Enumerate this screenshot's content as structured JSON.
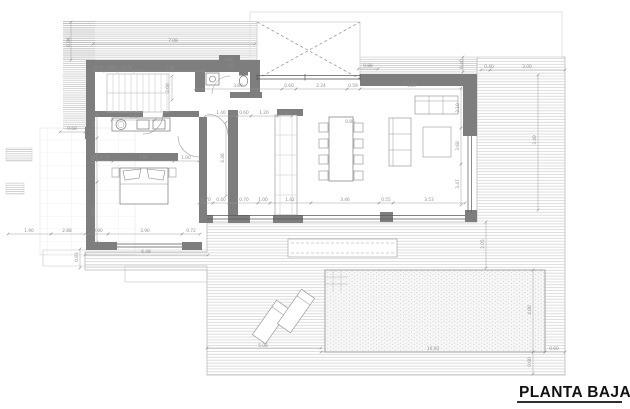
{
  "title": "PLANTA BAJA",
  "colors": {
    "wall": "#7e7e7e",
    "line": "#555555",
    "dim_text": "#8f8f8f",
    "dim_text_light": "#e8e8e8",
    "hatch": "#b2b2b2",
    "deck_hatch": "#c6c6c6",
    "pool_dot": "#b5b5b5",
    "title": "#111111"
  },
  "dimensions": [
    {
      "t": "7.08",
      "x": 173,
      "y": 42,
      "r": 0
    },
    {
      "t": "0.96",
      "x": 70,
      "y": 42,
      "r": -90
    },
    {
      "t": "0.45",
      "x": 99,
      "y": 69,
      "r": 0
    },
    {
      "t": "0.95",
      "x": 112,
      "y": 69,
      "r": 0
    },
    {
      "t": "0.78",
      "x": 127,
      "y": 69,
      "r": 0
    },
    {
      "t": "1.80",
      "x": 170,
      "y": 69,
      "r": 0
    },
    {
      "t": "2.08",
      "x": 169,
      "y": 88,
      "r": -90
    },
    {
      "t": "0.60",
      "x": 229,
      "y": 61,
      "r": 0,
      "c": "light"
    },
    {
      "t": "15",
      "x": 231,
      "y": 67,
      "r": 0
    },
    {
      "t": "3.80",
      "x": 238,
      "y": 87,
      "r": 0
    },
    {
      "t": "0.60",
      "x": 289,
      "y": 87,
      "r": 0
    },
    {
      "t": "2.24",
      "x": 321,
      "y": 87,
      "r": 0
    },
    {
      "t": "0.59",
      "x": 353,
      "y": 87,
      "r": 0
    },
    {
      "t": "5.87",
      "x": 412,
      "y": 87,
      "r": 0
    },
    {
      "t": "0.88",
      "x": 368,
      "y": 67,
      "r": 0
    },
    {
      "t": "0.40",
      "x": 463,
      "y": 64,
      "r": -90
    },
    {
      "t": "0.40",
      "x": 489,
      "y": 68,
      "r": 0
    },
    {
      "t": "3.00",
      "x": 527,
      "y": 68,
      "r": 0
    },
    {
      "t": "3.40",
      "x": 536,
      "y": 140,
      "r": -90
    },
    {
      "t": "2.10",
      "x": 459,
      "y": 108,
      "r": -90
    },
    {
      "t": "3.68",
      "x": 459,
      "y": 146,
      "r": -90
    },
    {
      "t": "3.47",
      "x": 459,
      "y": 184,
      "r": -90
    },
    {
      "t": "1.40",
      "x": 221,
      "y": 114,
      "r": 0
    },
    {
      "t": "0.60",
      "x": 244,
      "y": 114,
      "r": 0
    },
    {
      "t": "1.20",
      "x": 264,
      "y": 114,
      "r": 0
    },
    {
      "t": "0.60",
      "x": 285,
      "y": 114,
      "r": 0
    },
    {
      "t": "4.46",
      "x": 224,
      "y": 158,
      "r": -90
    },
    {
      "t": "1.80",
      "x": 134,
      "y": 118,
      "r": 0
    },
    {
      "t": "1.91",
      "x": 95,
      "y": 126,
      "r": -90
    },
    {
      "t": "2.06",
      "x": 95,
      "y": 160,
      "r": -90
    },
    {
      "t": "3.60",
      "x": 95,
      "y": 212,
      "r": -90
    },
    {
      "t": "0.70",
      "x": 105,
      "y": 159,
      "r": 0
    },
    {
      "t": "2.68",
      "x": 143,
      "y": 159,
      "r": 0
    },
    {
      "t": "1.00",
      "x": 186,
      "y": 159,
      "r": 0
    },
    {
      "t": "0.90",
      "x": 98,
      "y": 232,
      "r": 0
    },
    {
      "t": "3.90",
      "x": 145,
      "y": 232,
      "r": 0
    },
    {
      "t": "0.72",
      "x": 191,
      "y": 232,
      "r": 0
    },
    {
      "t": "6.48",
      "x": 146,
      "y": 253,
      "r": 0
    },
    {
      "t": "1.90",
      "x": 29,
      "y": 232,
      "r": 0
    },
    {
      "t": "2.88",
      "x": 67,
      "y": 232,
      "r": 0
    },
    {
      "t": "0.68",
      "x": 72,
      "y": 130,
      "r": 0
    },
    {
      "t": "0.83",
      "x": 78,
      "y": 257,
      "r": -90
    },
    {
      "t": "0.70",
      "x": 206,
      "y": 201,
      "r": 0
    },
    {
      "t": "0.40",
      "x": 221,
      "y": 201,
      "r": 0
    },
    {
      "t": "0.70",
      "x": 244,
      "y": 201,
      "r": 0
    },
    {
      "t": "1.00",
      "x": 263,
      "y": 201,
      "r": 0
    },
    {
      "t": "1.42",
      "x": 290,
      "y": 201,
      "r": 0
    },
    {
      "t": "3.46",
      "x": 345,
      "y": 201,
      "r": 0
    },
    {
      "t": "0.55",
      "x": 386,
      "y": 201,
      "r": 0
    },
    {
      "t": "3.53",
      "x": 429,
      "y": 201,
      "r": 0
    },
    {
      "t": "0.86",
      "x": 350,
      "y": 123,
      "r": 0
    },
    {
      "t": "5.08",
      "x": 263,
      "y": 347,
      "r": 0
    },
    {
      "t": "10.00",
      "x": 433,
      "y": 350,
      "r": 0
    },
    {
      "t": "0.60",
      "x": 554,
      "y": 350,
      "r": 0
    },
    {
      "t": "4.00",
      "x": 531,
      "y": 310,
      "r": -90
    },
    {
      "t": "0.60",
      "x": 531,
      "y": 362,
      "r": -90
    },
    {
      "t": "2.05",
      "x": 484,
      "y": 244,
      "r": -90
    }
  ]
}
